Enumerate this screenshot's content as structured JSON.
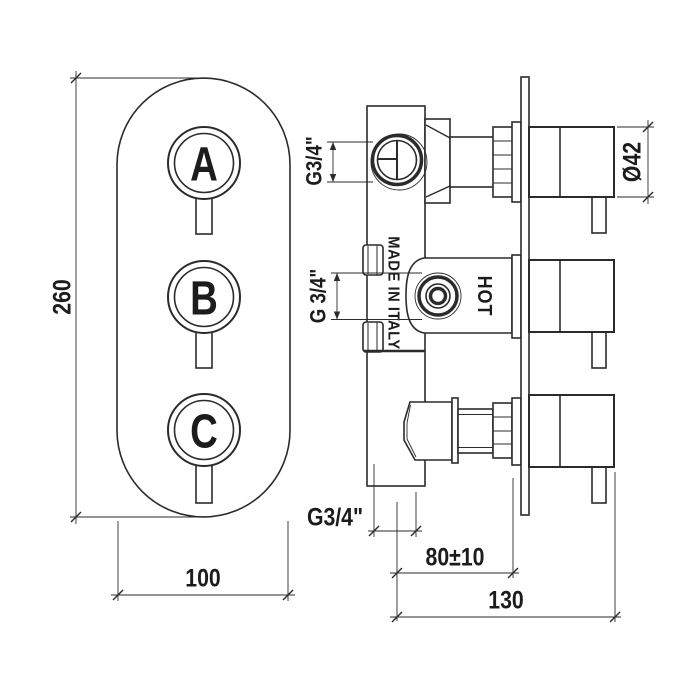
{
  "front_view": {
    "knobs": [
      "A",
      "B",
      "C"
    ],
    "height_dim": "260",
    "width_dim": "100"
  },
  "side_view": {
    "top_port_dim": "G3/4\"",
    "side_port_dim": "G 3/4\"",
    "knob_diameter_dim": "Ø42",
    "made_in_label": "MADE IN ITALY",
    "hot_label": "HOT",
    "bottom_port_dim": "G3/4\"",
    "wall_depth_dim": "80±10",
    "total_depth_dim": "130"
  },
  "colors": {
    "line": "#2b2b2b",
    "background": "#ffffff"
  }
}
